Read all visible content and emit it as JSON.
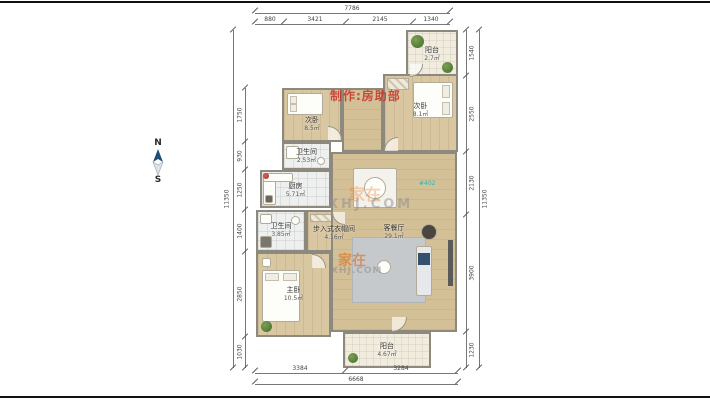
{
  "compass": {
    "north": "N",
    "south": "S"
  },
  "watermarks": {
    "maker": "制作:房助部",
    "brand_top": {
      "cn": "家在",
      "en": "XHJ.COM"
    },
    "brand_bottom": {
      "cn": "家在",
      "en": "XHJ.COM"
    },
    "unit_tag": "#402"
  },
  "rooms": {
    "balcony_top": {
      "name": "阳台",
      "area": "2.7㎡"
    },
    "bedroom_left": {
      "name": "次卧",
      "area": "8.5㎡"
    },
    "bedroom_right": {
      "name": "次卧",
      "area": "8.1㎡"
    },
    "bathroom_top": {
      "name": "卫生间",
      "area": "2.53㎡"
    },
    "kitchen": {
      "name": "厨房",
      "area": "5.71㎡"
    },
    "bathroom_bottom": {
      "name": "卫生间",
      "area": "3.85㎡"
    },
    "closet": {
      "name": "步入式衣帽间",
      "area": "4.16㎡"
    },
    "master_bedroom": {
      "name": "主卧",
      "area": "10.5㎡"
    },
    "living_dining": {
      "name": "客餐厅",
      "area": "29.1㎡"
    },
    "balcony_bottom": {
      "name": "阳台",
      "area": "4.67㎡"
    }
  },
  "dimensions": {
    "top": {
      "total": "7786",
      "segments": [
        "880",
        "3421",
        "2145",
        "1340"
      ]
    },
    "bottom": {
      "total": "6668",
      "segments": [
        "3384",
        "3284"
      ]
    },
    "left": {
      "total": "11350",
      "segments": [
        "1750",
        "930",
        "1250",
        "1400",
        "2850",
        "1030"
      ]
    },
    "right": {
      "total": "11350",
      "segments": [
        "1540",
        "2550",
        "2130",
        "3900",
        "1230"
      ]
    }
  }
}
